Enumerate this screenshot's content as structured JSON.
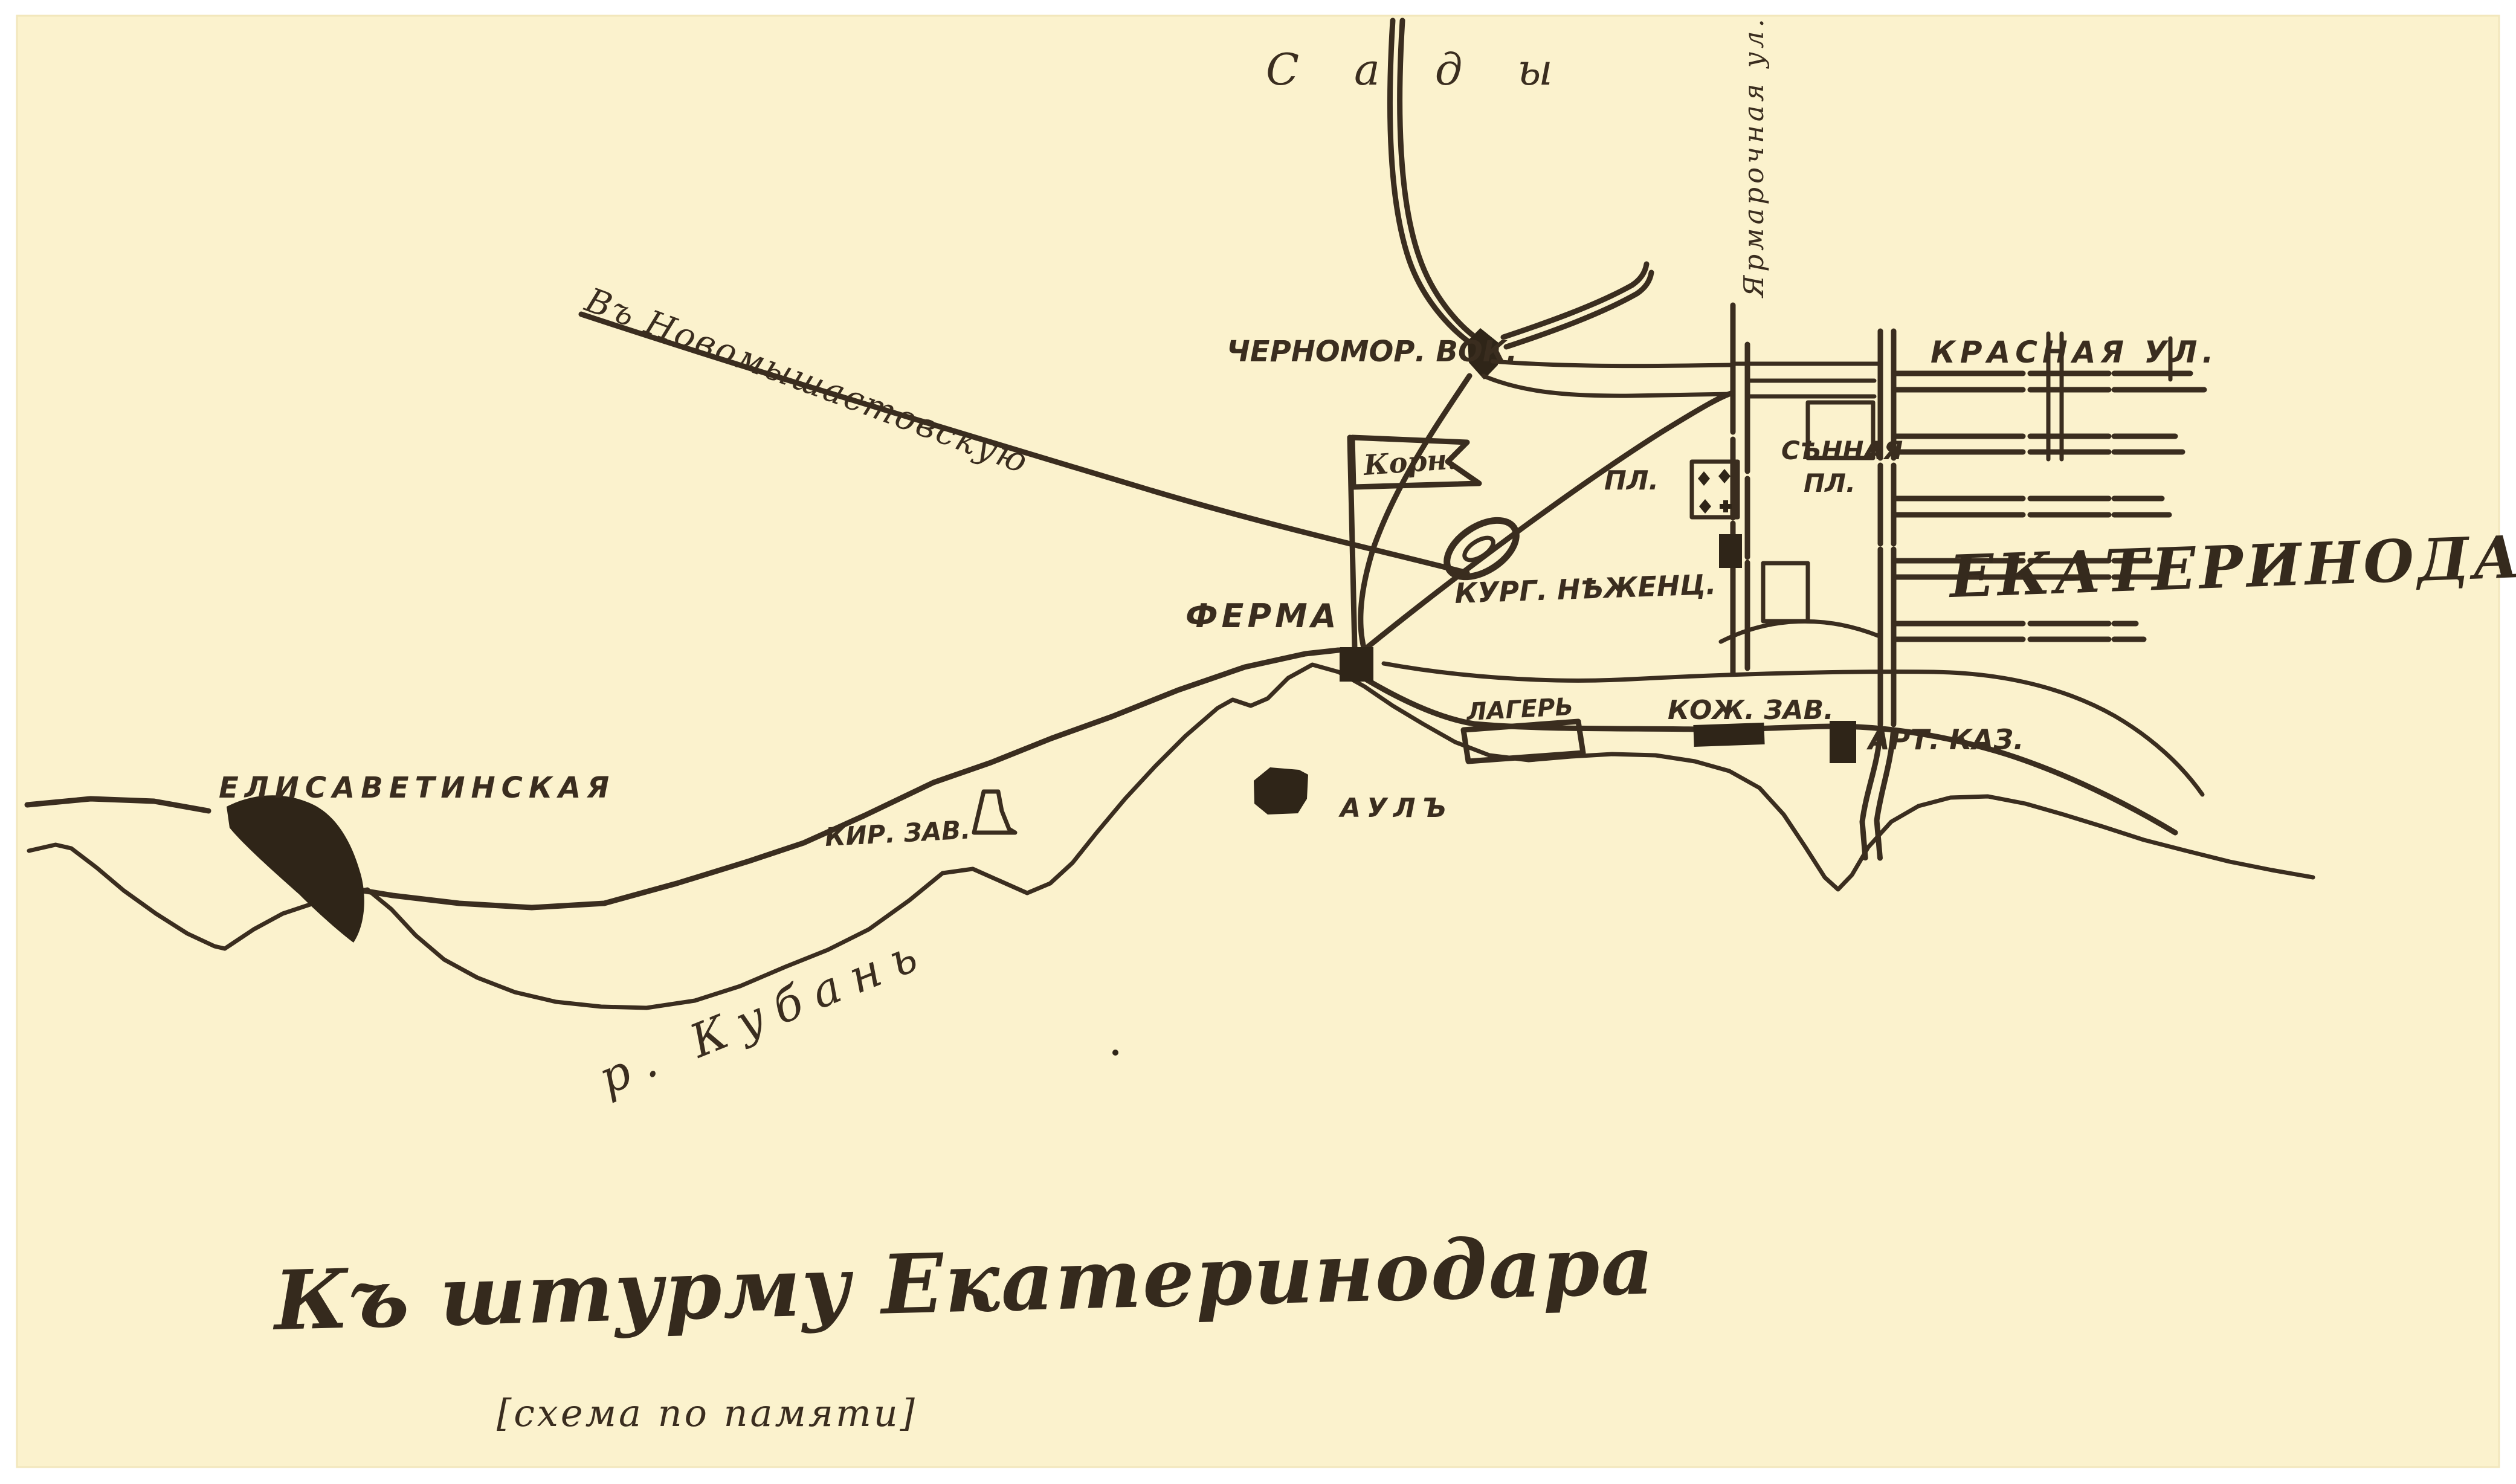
{
  "colors": {
    "paper": "#fbf2cd",
    "ink": "#3a2d1f",
    "frame": "#ffffff"
  },
  "title": {
    "main": "Къ штурму Екатеринодара",
    "subtitle": "[схема по памяти]"
  },
  "city": {
    "name": "ЕКАТЕРИНОДАРЪ"
  },
  "labels": {
    "gardens": "С а д ы",
    "yarmarochnaya_street": "Ярмарочная ул.",
    "krasnaya_street": "КРАСНАЯ УЛ.",
    "sennaya_square_line1": "СѢННАЯ",
    "sennaya_square_line2": "ПЛ.",
    "square_west": "ПЛ.",
    "station": "ЧЕРНОМОР. ВОК.",
    "kornilov_flag": "Корн.",
    "kurgan": "КУРГ. НѢЖЕНЦ.",
    "farm": "ФЕРМА",
    "road_to_novomyshastovskaya": "Въ Новомышастовскую",
    "elisavetinskaya": "ЕЛИСАВЕТИНСКАЯ",
    "brick_factory": "КИР. ЗАВ.",
    "aul": "АУЛЪ",
    "camp": "ЛАГЕРЬ",
    "leather_factory": "КОЖ. ЗАВ.",
    "artillery_barracks": "АРТ. КАЗ.",
    "kuban_river": "р. Кубань"
  }
}
